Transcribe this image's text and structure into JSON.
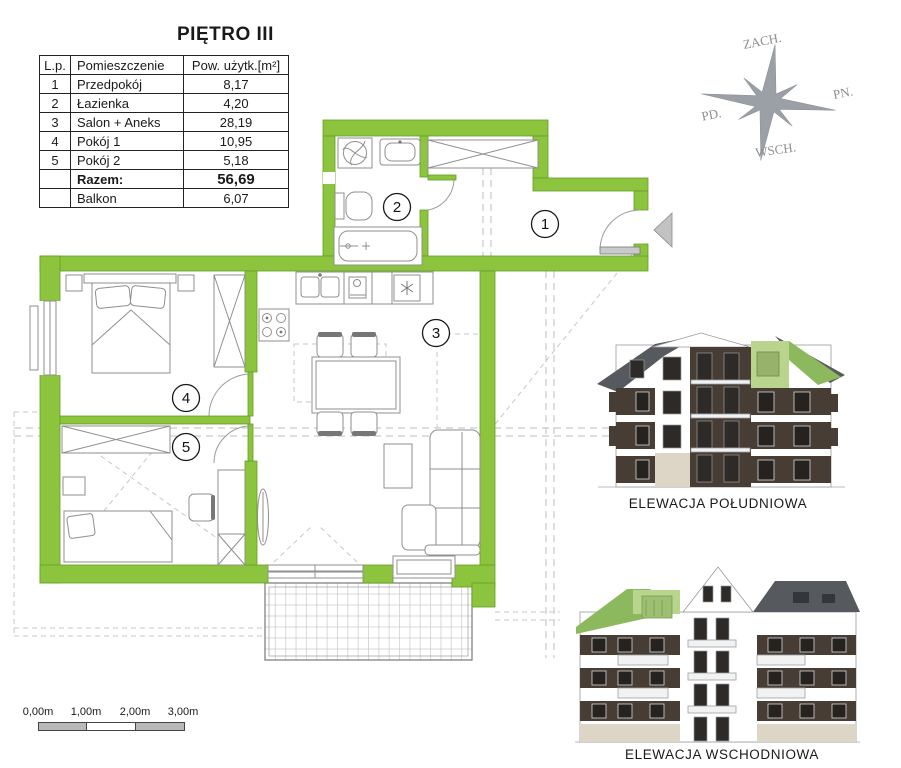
{
  "title": "PIĘTRO III",
  "table": {
    "headers": [
      "L.p.",
      "Pomieszczenie",
      "Pow. użytk.[m²]"
    ],
    "rows": [
      {
        "lp": "1",
        "name": "Przedpokój",
        "area": "8,17"
      },
      {
        "lp": "2",
        "name": "Łazienka",
        "area": "4,20"
      },
      {
        "lp": "3",
        "name": "Salon + Aneks",
        "area": "28,19"
      },
      {
        "lp": "4",
        "name": "Pokój 1",
        "area": "10,95"
      },
      {
        "lp": "5",
        "name": "Pokój 2",
        "area": "5,18"
      },
      {
        "lp": "",
        "name": "Razem:",
        "area": "56,69"
      },
      {
        "lp": "",
        "name": "Balkon",
        "area": "6,07"
      }
    ]
  },
  "compass": {
    "top": "ZACH.",
    "right": "PN.",
    "left": "PD.",
    "bottom": "WSCH."
  },
  "plan": {
    "room_labels": {
      "r1": "1",
      "r2": "2",
      "r3": "3",
      "r4": "4",
      "r5": "5"
    }
  },
  "elevations": {
    "south_caption": "ELEWACJA POŁUDNIOWA",
    "east_caption": "ELEWACJA WSCHODNIOWA"
  },
  "scalebar": {
    "labels": [
      "0,00m",
      "1,00m",
      "2,00m",
      "3,00m"
    ]
  },
  "colors": {
    "wall_green": "#8cc43e",
    "highlight_green": "#b9d48c",
    "facade_dark": "#473d35",
    "roof_gray": "#565a5e",
    "stone": "#ddd5c6"
  }
}
